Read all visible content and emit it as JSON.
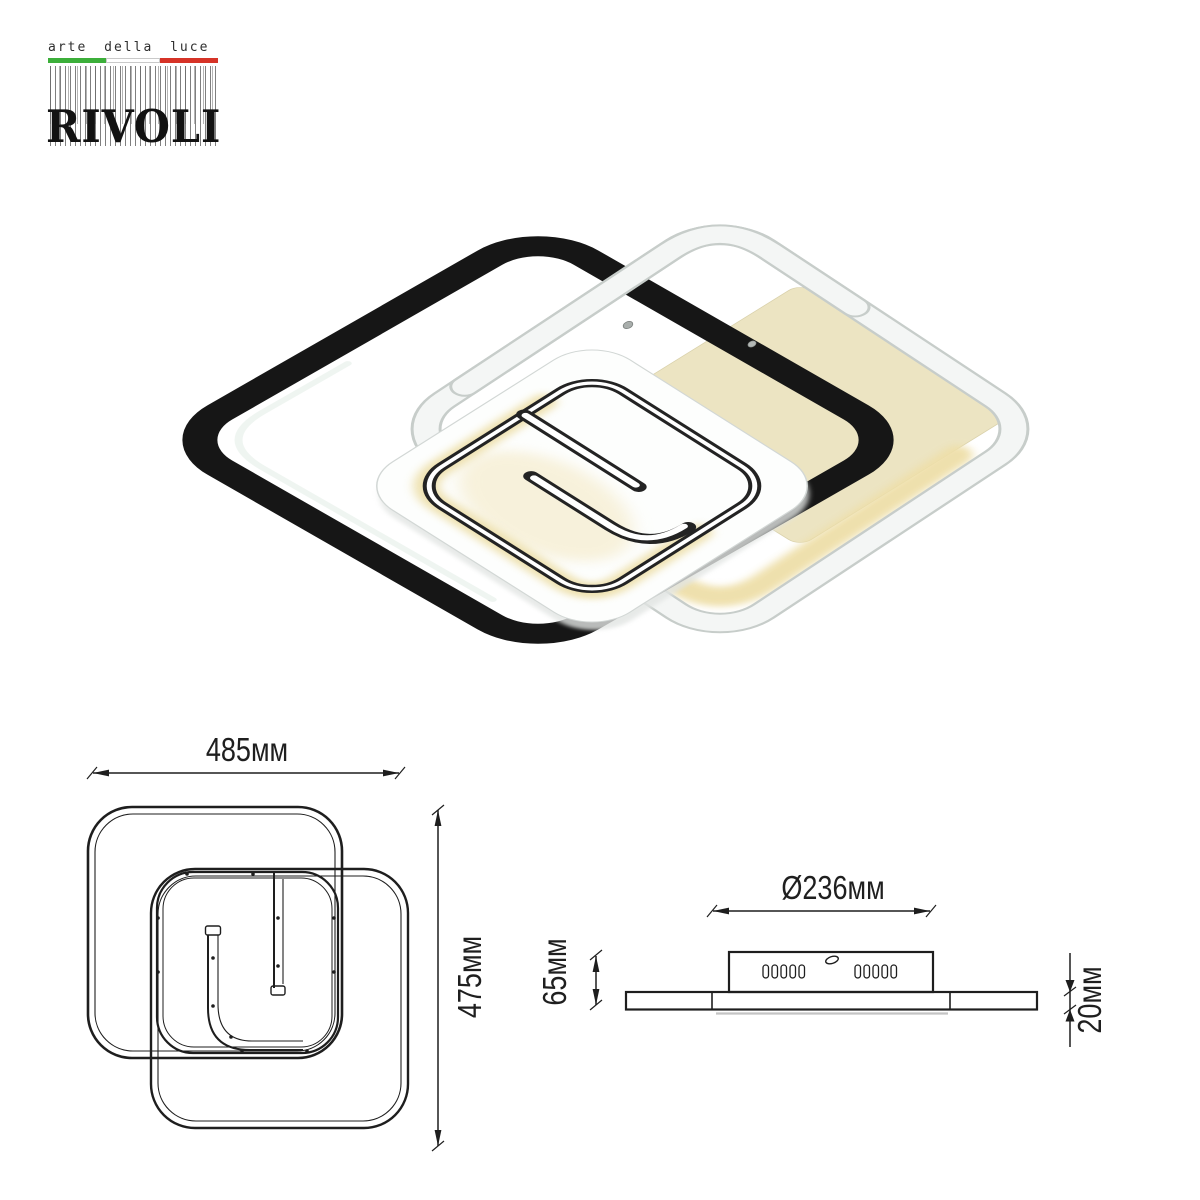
{
  "logo": {
    "tagline": "arte della luce",
    "brand": "RIVOLI",
    "flag": {
      "green": "#3caf3a",
      "white": "#ffffff",
      "red": "#d63327"
    }
  },
  "product": {
    "type": "led-ceiling-light",
    "frame_black_color": "#161616",
    "frame_white_color": "#f4f6f5",
    "led_warm_color": "#eedfa9",
    "canopy_color": "#ece4c2"
  },
  "drawings": {
    "top_view": {
      "width": "485мм",
      "height": "475мм"
    },
    "side_view": {
      "diameter": "Ø236мм",
      "height": "65мм",
      "thickness": "20мм"
    }
  }
}
